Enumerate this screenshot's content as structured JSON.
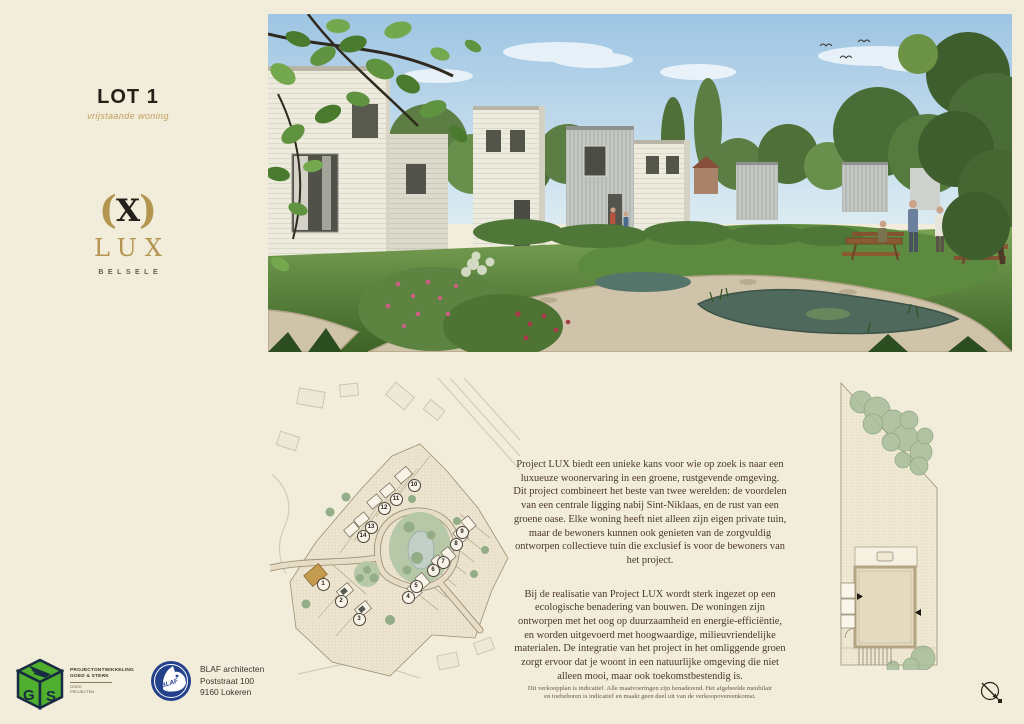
{
  "header": {
    "lot_title": "LOT 1",
    "lot_subtitle": "vrijstaande woning"
  },
  "brand": {
    "paren_open": "(",
    "x_mark": "X",
    "paren_close": ")",
    "name": "LUX",
    "location": "BELSELE",
    "gold": "#b3954f"
  },
  "description": {
    "paragraph1": "Project LUX biedt een unieke kans voor wie op zoek is naar een luxueuze woonervaring in een groene, rustgevende omgeving. Dit project combineert het beste van twee werelden: de voordelen van een centrale ligging nabij Sint-Niklaas, en de rust van een groene oase. Elke woning heeft niet alleen zijn eigen private tuin, maar de bewoners kunnen ook genieten van de zorgvuldig ontworpen collectieve tuin die exclusief is voor de bewoners van het project.",
    "paragraph2": "Bij de realisatie van Project LUX wordt sterk ingezet op een ecologische benadering van bouwen. De woningen zijn ontworpen met het oog op duurzaamheid en energie-efficiëntie, en worden uitgevoerd met hoogwaardige, milieuvriendelijke materialen. De integratie van het project in het omliggende groen zorgt ervoor dat je woont in een natuurlijke omgeving die niet alleen mooi, maar ook toekomstbestendig is."
  },
  "site_plan": {
    "highlight_color": "#c49a4e",
    "lots": [
      {
        "number": "1",
        "x": 52,
        "y": 205,
        "highlight": true
      },
      {
        "number": "2",
        "x": 70,
        "y": 222
      },
      {
        "number": "3",
        "x": 88,
        "y": 240
      },
      {
        "number": "4",
        "x": 137,
        "y": 218
      },
      {
        "number": "5",
        "x": 145,
        "y": 207
      },
      {
        "number": "6",
        "x": 162,
        "y": 191
      },
      {
        "number": "7",
        "x": 172,
        "y": 183
      },
      {
        "number": "8",
        "x": 185,
        "y": 165
      },
      {
        "number": "9",
        "x": 191,
        "y": 153
      },
      {
        "number": "10",
        "x": 143,
        "y": 106
      },
      {
        "number": "11",
        "x": 125,
        "y": 120
      },
      {
        "number": "12",
        "x": 113,
        "y": 129
      },
      {
        "number": "13",
        "x": 100,
        "y": 148
      },
      {
        "number": "14",
        "x": 92,
        "y": 157
      }
    ]
  },
  "footer": {
    "developer": {
      "logo_letters": "GS",
      "line1": "PROJECTONTWIKKELING",
      "line2": "GOED & STERK",
      "sub_line1": "GOED",
      "sub_line2": "PROJECTEN"
    },
    "architect": {
      "logo_text": "BLAF",
      "name": "BLAF architecten",
      "street": "Poststraat 100",
      "city": "9160 Lokeren"
    },
    "disclaimer_line1": "Dit verkoopplan is indicatief. Alle maatvoeringen zijn benaderend. Het afgebeelde meubilair",
    "disclaimer_line2": "en toebehoren is indicatief en maakt geen deel uit van de verkoopovereenkomst."
  }
}
